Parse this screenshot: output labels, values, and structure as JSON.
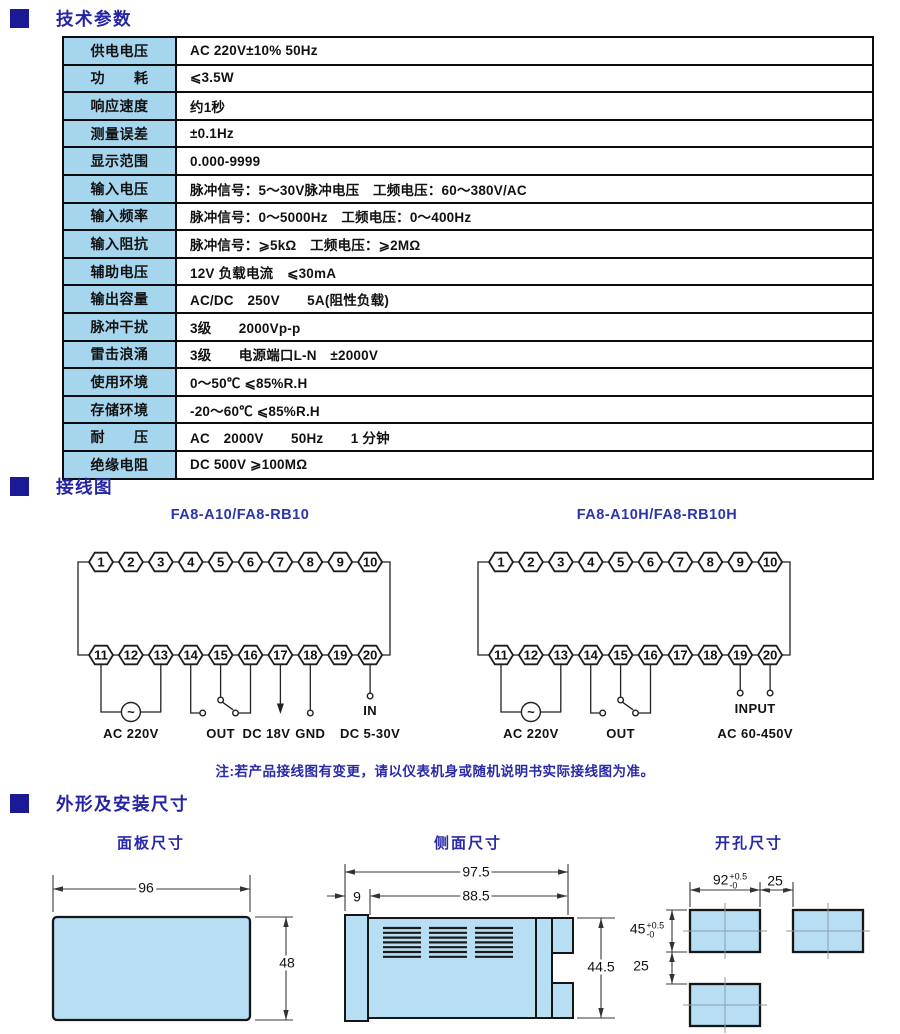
{
  "colors": {
    "accent": "#2424a4",
    "bullet": "#1a1a96",
    "table_label_bg": "#a6d6ee",
    "drawing_fill": "#b7def2"
  },
  "sections": [
    {
      "title": "技术参数"
    },
    {
      "title": "接线图"
    },
    {
      "title": "外形及安装尺寸"
    }
  ],
  "specs_table": {
    "rows": [
      {
        "label": "供电电压",
        "value": "AC 220V±10% 50Hz"
      },
      {
        "label": "功　　耗",
        "value": "⩽3.5W"
      },
      {
        "label": "响应速度",
        "value": "约1秒"
      },
      {
        "label": "测量误差",
        "value": "±0.1Hz"
      },
      {
        "label": "显示范围",
        "value": "0.000-9999"
      },
      {
        "label": "输入电压",
        "value": "脉冲信号：5～30V脉冲电压　工频电压：60～380V/AC"
      },
      {
        "label": "输入频率",
        "value": "脉冲信号：0～5000Hz　工频电压：0～400Hz"
      },
      {
        "label": "输入阻抗",
        "value": "脉冲信号：⩾5kΩ　工频电压：⩾2MΩ"
      },
      {
        "label": "辅助电压",
        "value": "12V 负载电流　⩽30mA"
      },
      {
        "label": "输出容量",
        "value": "AC/DC　250V　　5A(阻性负载)"
      },
      {
        "label": "脉冲干扰",
        "value": "3级　　2000Vp-p"
      },
      {
        "label": "雷击浪涌",
        "value": "3级　　电源端口L-N　±2000V"
      },
      {
        "label": "使用环境",
        "value": "0～50℃ ⩽85%R.H"
      },
      {
        "label": "存储环境",
        "value": "-20～60℃ ⩽85%R.H"
      },
      {
        "label": "耐　　压",
        "value": "AC　2000V　　50Hz　　1 分钟"
      },
      {
        "label": "绝缘电阻",
        "value": "DC 500V ⩾100MΩ"
      }
    ]
  },
  "wiring": {
    "note": "注:若产品接线图有变更，请以仪表机身或随机说明书实际接线图为准。",
    "diagrams": [
      {
        "title": "FA8-A10/FA8-RB10",
        "top_terminals": [
          "1",
          "2",
          "3",
          "4",
          "5",
          "6",
          "7",
          "8",
          "9",
          "10"
        ],
        "bottom_terminals": [
          "11",
          "12",
          "13",
          "14",
          "15",
          "16",
          "17",
          "18",
          "19",
          "20"
        ],
        "features": [
          {
            "type": "ac",
            "a": 0,
            "b": 2,
            "label": "AC 220V"
          },
          {
            "type": "relay",
            "left": 3,
            "pole": 4,
            "right": 5,
            "label": "OUT"
          },
          {
            "type": "arrow",
            "t": 6,
            "label": "DC 18V",
            "label_dx": -14
          },
          {
            "type": "pin",
            "t": 7,
            "label": "GND"
          },
          {
            "type": "pin2",
            "t": 9,
            "label1": "IN",
            "label2": "DC 5-30V"
          }
        ]
      },
      {
        "title": "FA8-A10H/FA8-RB10H",
        "top_terminals": [
          "1",
          "2",
          "3",
          "4",
          "5",
          "6",
          "7",
          "8",
          "9",
          "10"
        ],
        "bottom_terminals": [
          "11",
          "12",
          "13",
          "14",
          "15",
          "16",
          "17",
          "18",
          "19",
          "20"
        ],
        "features": [
          {
            "type": "ac",
            "a": 0,
            "b": 2,
            "label": "AC 220V"
          },
          {
            "type": "relay",
            "left": 3,
            "pole": 4,
            "right": 5,
            "label": "OUT"
          },
          {
            "type": "pinpair",
            "a": 8,
            "b": 9,
            "label1": "INPUT",
            "label2": "AC 60-450V"
          }
        ]
      }
    ]
  },
  "dimensions": {
    "panel": {
      "title": "面板尺寸",
      "width": "96",
      "height": "48"
    },
    "side": {
      "title": "侧面尺寸",
      "depth_total": "97.5",
      "depth_body": "88.5",
      "bezel": "9",
      "height": "44.5"
    },
    "cutout": {
      "title": "开孔尺寸",
      "width": "92",
      "width_tol_plus": "+0.5",
      "width_tol_minus": "-0",
      "gap_h": "25",
      "height": "45",
      "height_tol_plus": "+0.5",
      "height_tol_minus": "-0",
      "gap_v": "25"
    }
  }
}
